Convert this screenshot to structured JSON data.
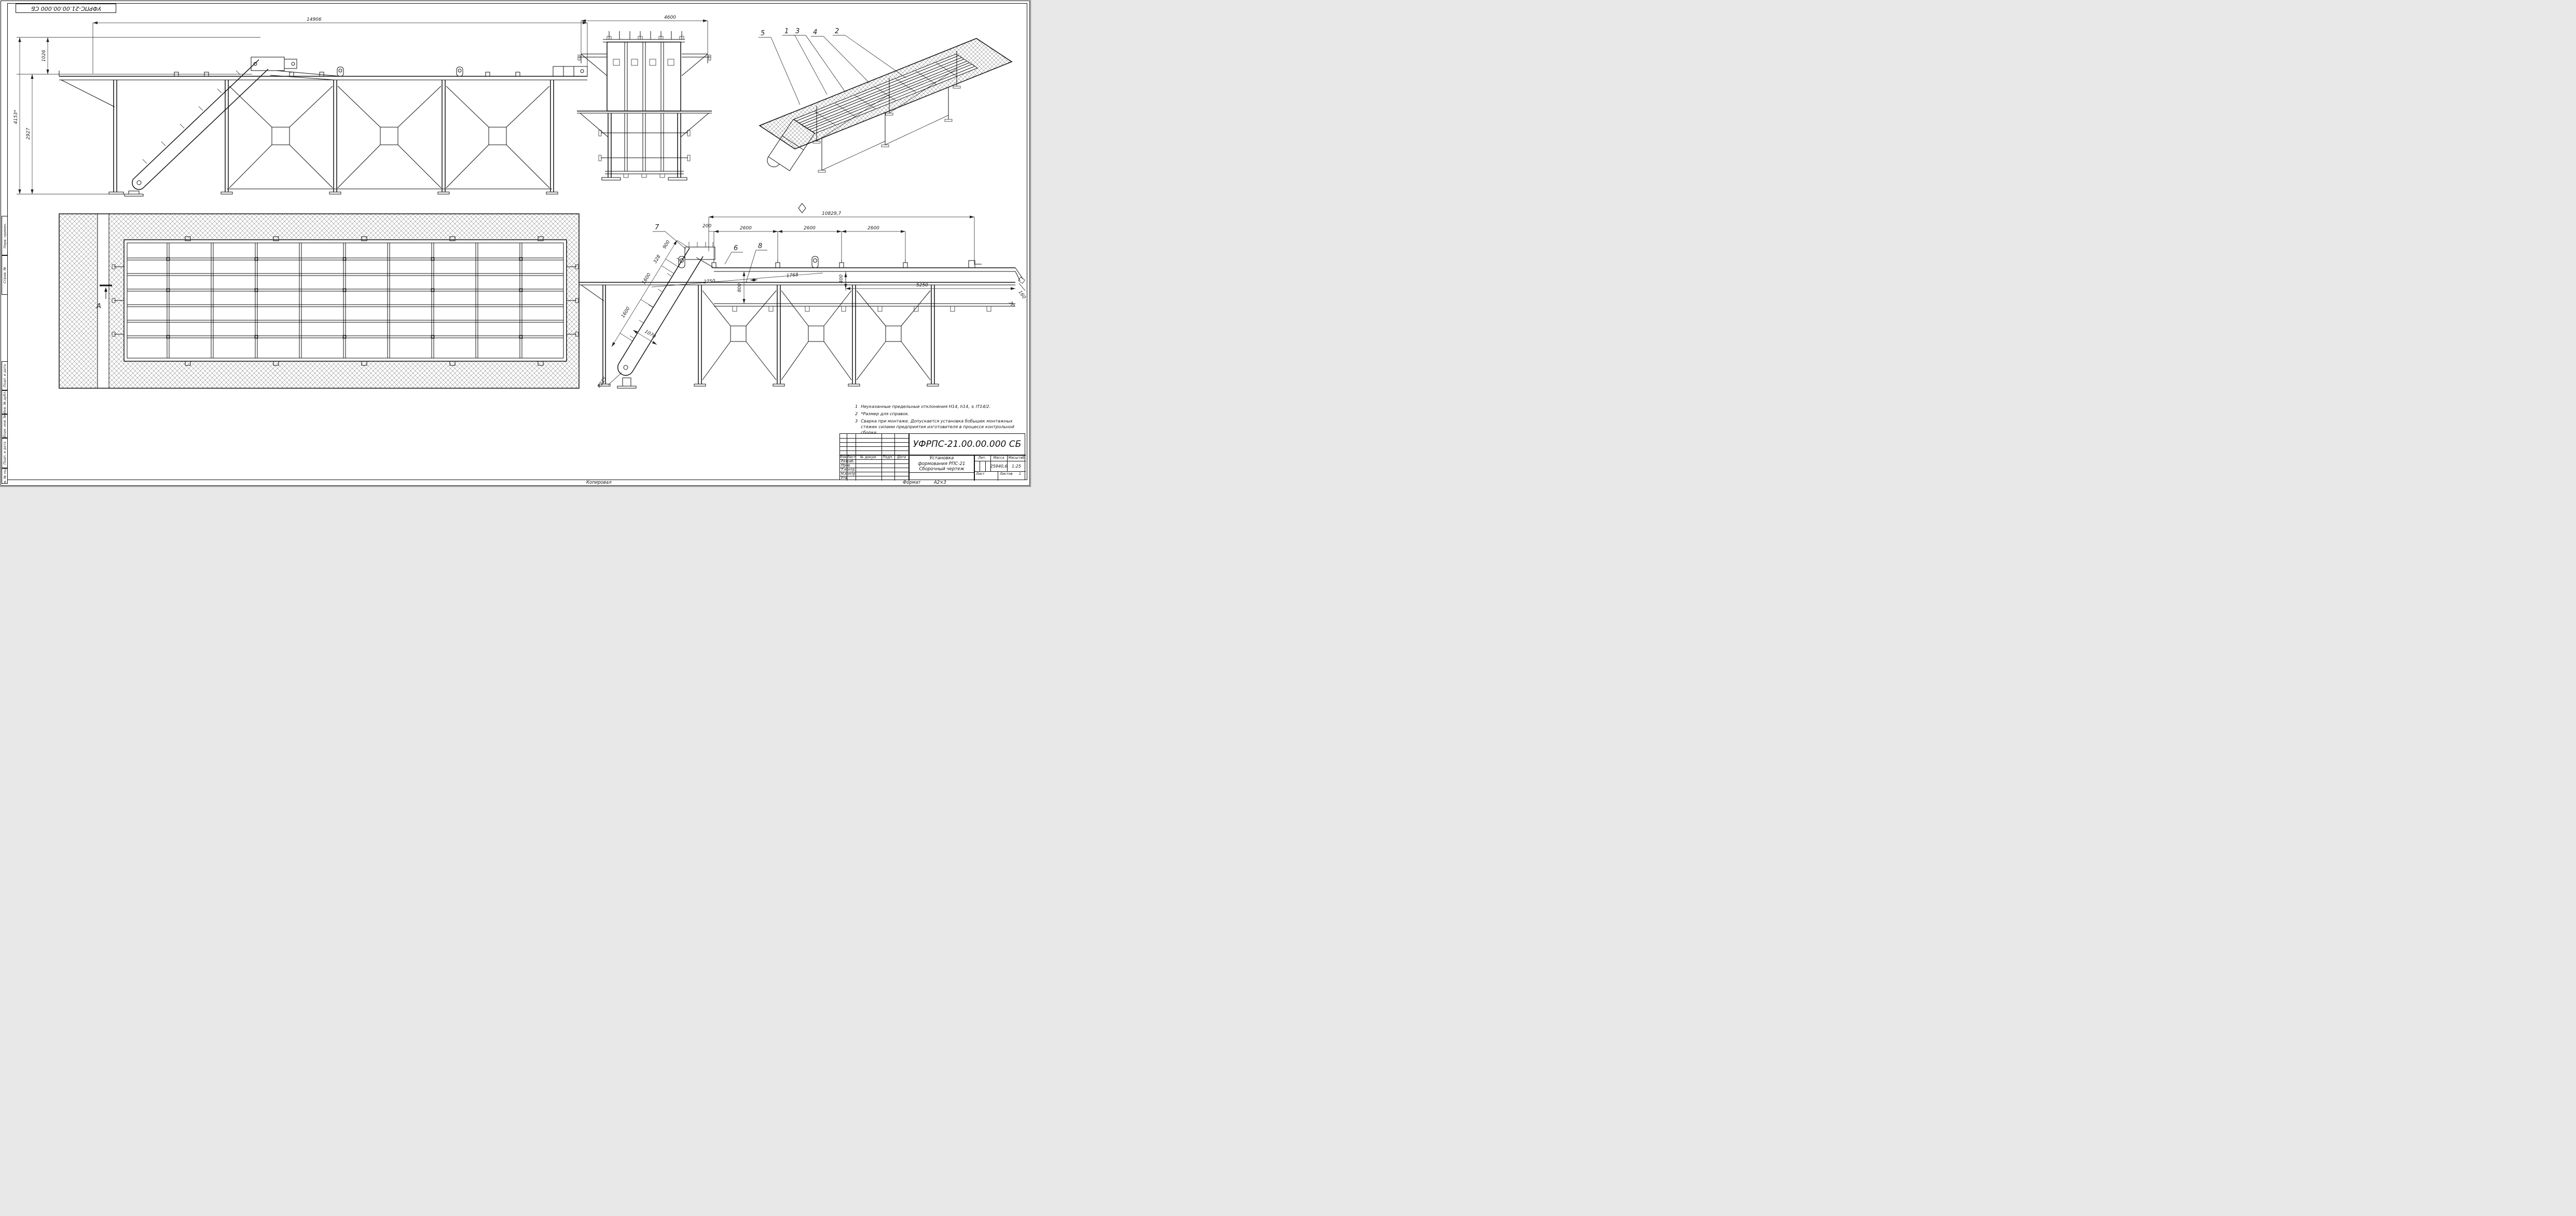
{
  "sheet": {
    "corner_stamp": "УФРПС-21.00.00.000 СБ",
    "margins": {
      "m1": "Перв. примен.",
      "m2": "Справ. №",
      "m3": "Подп. и дата",
      "m4": "Инв. № дубл.",
      "m5": "Взам. инв. №",
      "m6": "Подп. и дата",
      "m7": "Инв. № подл."
    },
    "footer": {
      "copied": "Копировал",
      "format_label": "Формат",
      "format_value": "А2×3"
    }
  },
  "views": {
    "front": {
      "dims": {
        "overall": "14906",
        "total_h": "4153*",
        "deck_h": "2927",
        "upper_h": "1026"
      }
    },
    "end": {
      "dims": {
        "width": "4600"
      }
    },
    "iso": {
      "callouts": {
        "c5": "5",
        "c1": "1",
        "c3": "3",
        "c4": "4",
        "c2": "2"
      }
    },
    "plan": {
      "section": "А"
    },
    "side": {
      "dims": {
        "overall": "10829,7",
        "seg200": "200",
        "bay1": "2600",
        "bay2": "2600",
        "bay3": "2600",
        "len5250": "5250",
        "v400": "400",
        "v800": "800",
        "i900": "900",
        "i328": "328",
        "i1600a": "1600",
        "i1600b": "1600",
        "w1070": "1070",
        "s2750": "2750",
        "s1768": "1768",
        "radius": "R215",
        "e160": "160",
        "e30": "30"
      },
      "callouts": {
        "c6": "6",
        "c7": "7",
        "c8": "8"
      }
    }
  },
  "notes": {
    "n1_num": "1",
    "n1": "Неуказанные предельные отклонения Н14, h14, ± IT14/2.",
    "n2_num": "2",
    "n2": "*Размер для справок.",
    "n3_num": "3",
    "n3": "Сварка при монтаже. Допускается установка бобышек монтажных стяжек силами предприятия изготовителя в процессе контрольной сборки."
  },
  "title_block": {
    "doc_number": "УФРПС-21.00.00.000 СБ",
    "name_line1": "Установка",
    "name_line2": "формования РПС-21",
    "name_line3": "Сборочный чертеж",
    "lit_label": "Лит.",
    "mass_label": "Масса",
    "scale_label": "Масштаб",
    "mass": "25940,6",
    "scale": "1:25",
    "sheet_label": "Лист",
    "sheets_label": "Листов",
    "sheets": "1",
    "cols": {
      "izm": "Изм.",
      "list": "Лист",
      "doc": "№ докум.",
      "podp": "Подп.",
      "data": "Дата"
    },
    "rows": {
      "razrab": "Разраб.",
      "prov": "Пров.",
      "tkontr": "Т.контр.",
      "nkontr": "Н.контр.",
      "utv": "Утв."
    }
  }
}
